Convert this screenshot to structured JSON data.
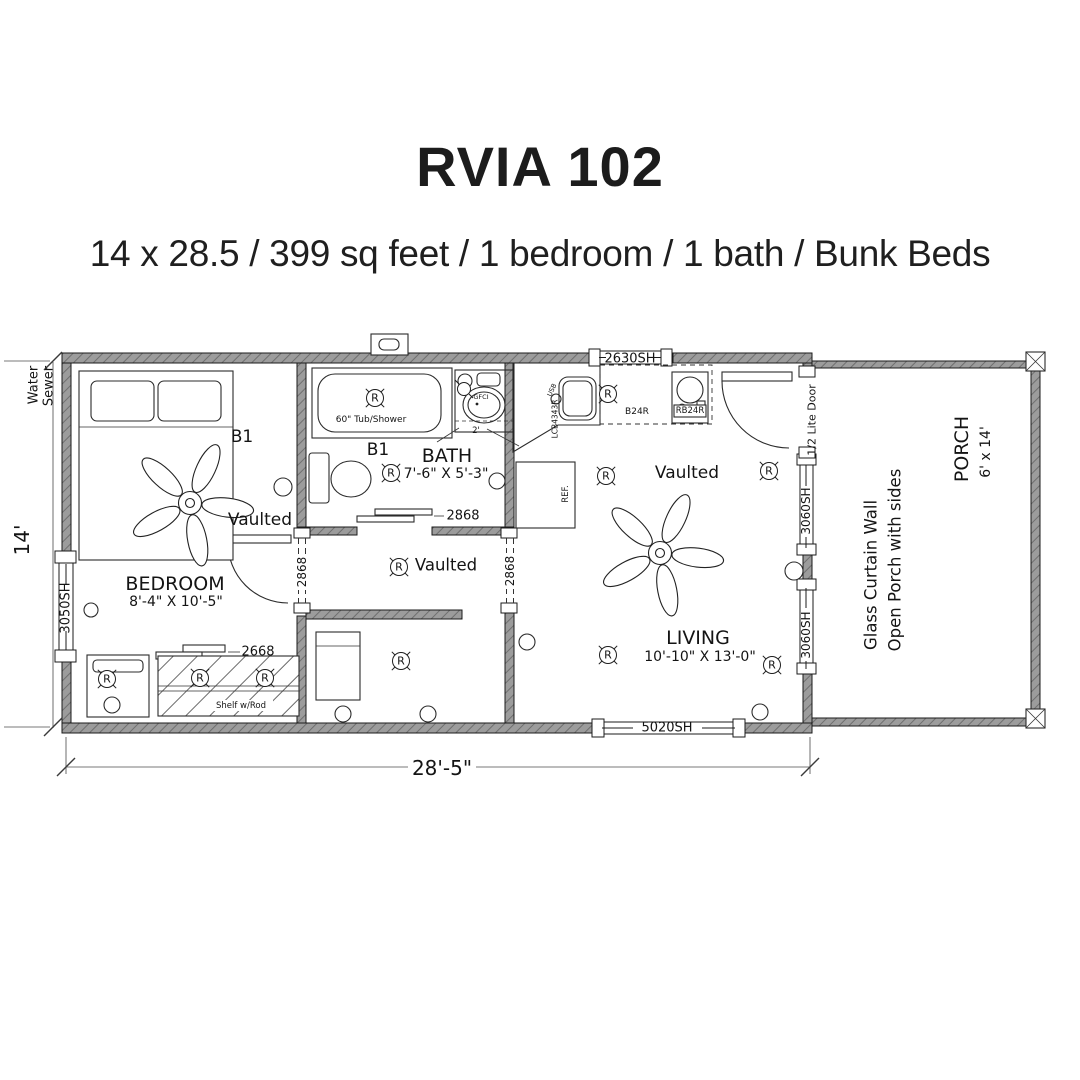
{
  "header": {
    "title": "RVIA 102",
    "subtitle": "14 x 28.5 / 399 sq feet / 1 bedroom / 1 bath / Bunk Beds"
  },
  "plan": {
    "dim_width": "28'-5\"",
    "dim_height": "14'",
    "water": "Water",
    "sewer": "Sewer",
    "receptacle": "R",
    "gfci_label": "GFCI",
    "usb_label": "USB",
    "counter_dim": "2'",
    "rooms": {
      "bedroom": {
        "name": "BEDROOM",
        "size": "8'-4\" X 10'-5\"",
        "bed_label": "B1",
        "ceiling": "Vaulted"
      },
      "bath": {
        "name": "BATH",
        "size": "7'-6\" X 5'-3\"",
        "bed_label": "B1",
        "tub": "60\" Tub/Shower"
      },
      "hall": {
        "ceiling": "Vaulted"
      },
      "living": {
        "name": "LIVING",
        "size": "10'-10\" X 13'-0\"",
        "ceiling": "Vaulted"
      },
      "porch": {
        "name": "PORCH",
        "size": "6' x 14'",
        "note1": "Glass Curtain Wall",
        "note2": "Open Porch with sides"
      }
    },
    "windows": {
      "left": "3050SH",
      "top": "2630SH",
      "right_upper": "3060SH",
      "right_lower": "3060SH",
      "bottom": "5020SH"
    },
    "doors": {
      "bath": "2868",
      "hall_west": "2868",
      "hall_east": "2868",
      "closet": "2668",
      "entry": "1/2 Lite Door"
    },
    "fixtures": {
      "closet_shelf": "Shelf w/Rod",
      "kitchen_sink": "LCB4343R",
      "cabinet": "B24R",
      "range": "RB24R",
      "fridge": "REF."
    }
  }
}
